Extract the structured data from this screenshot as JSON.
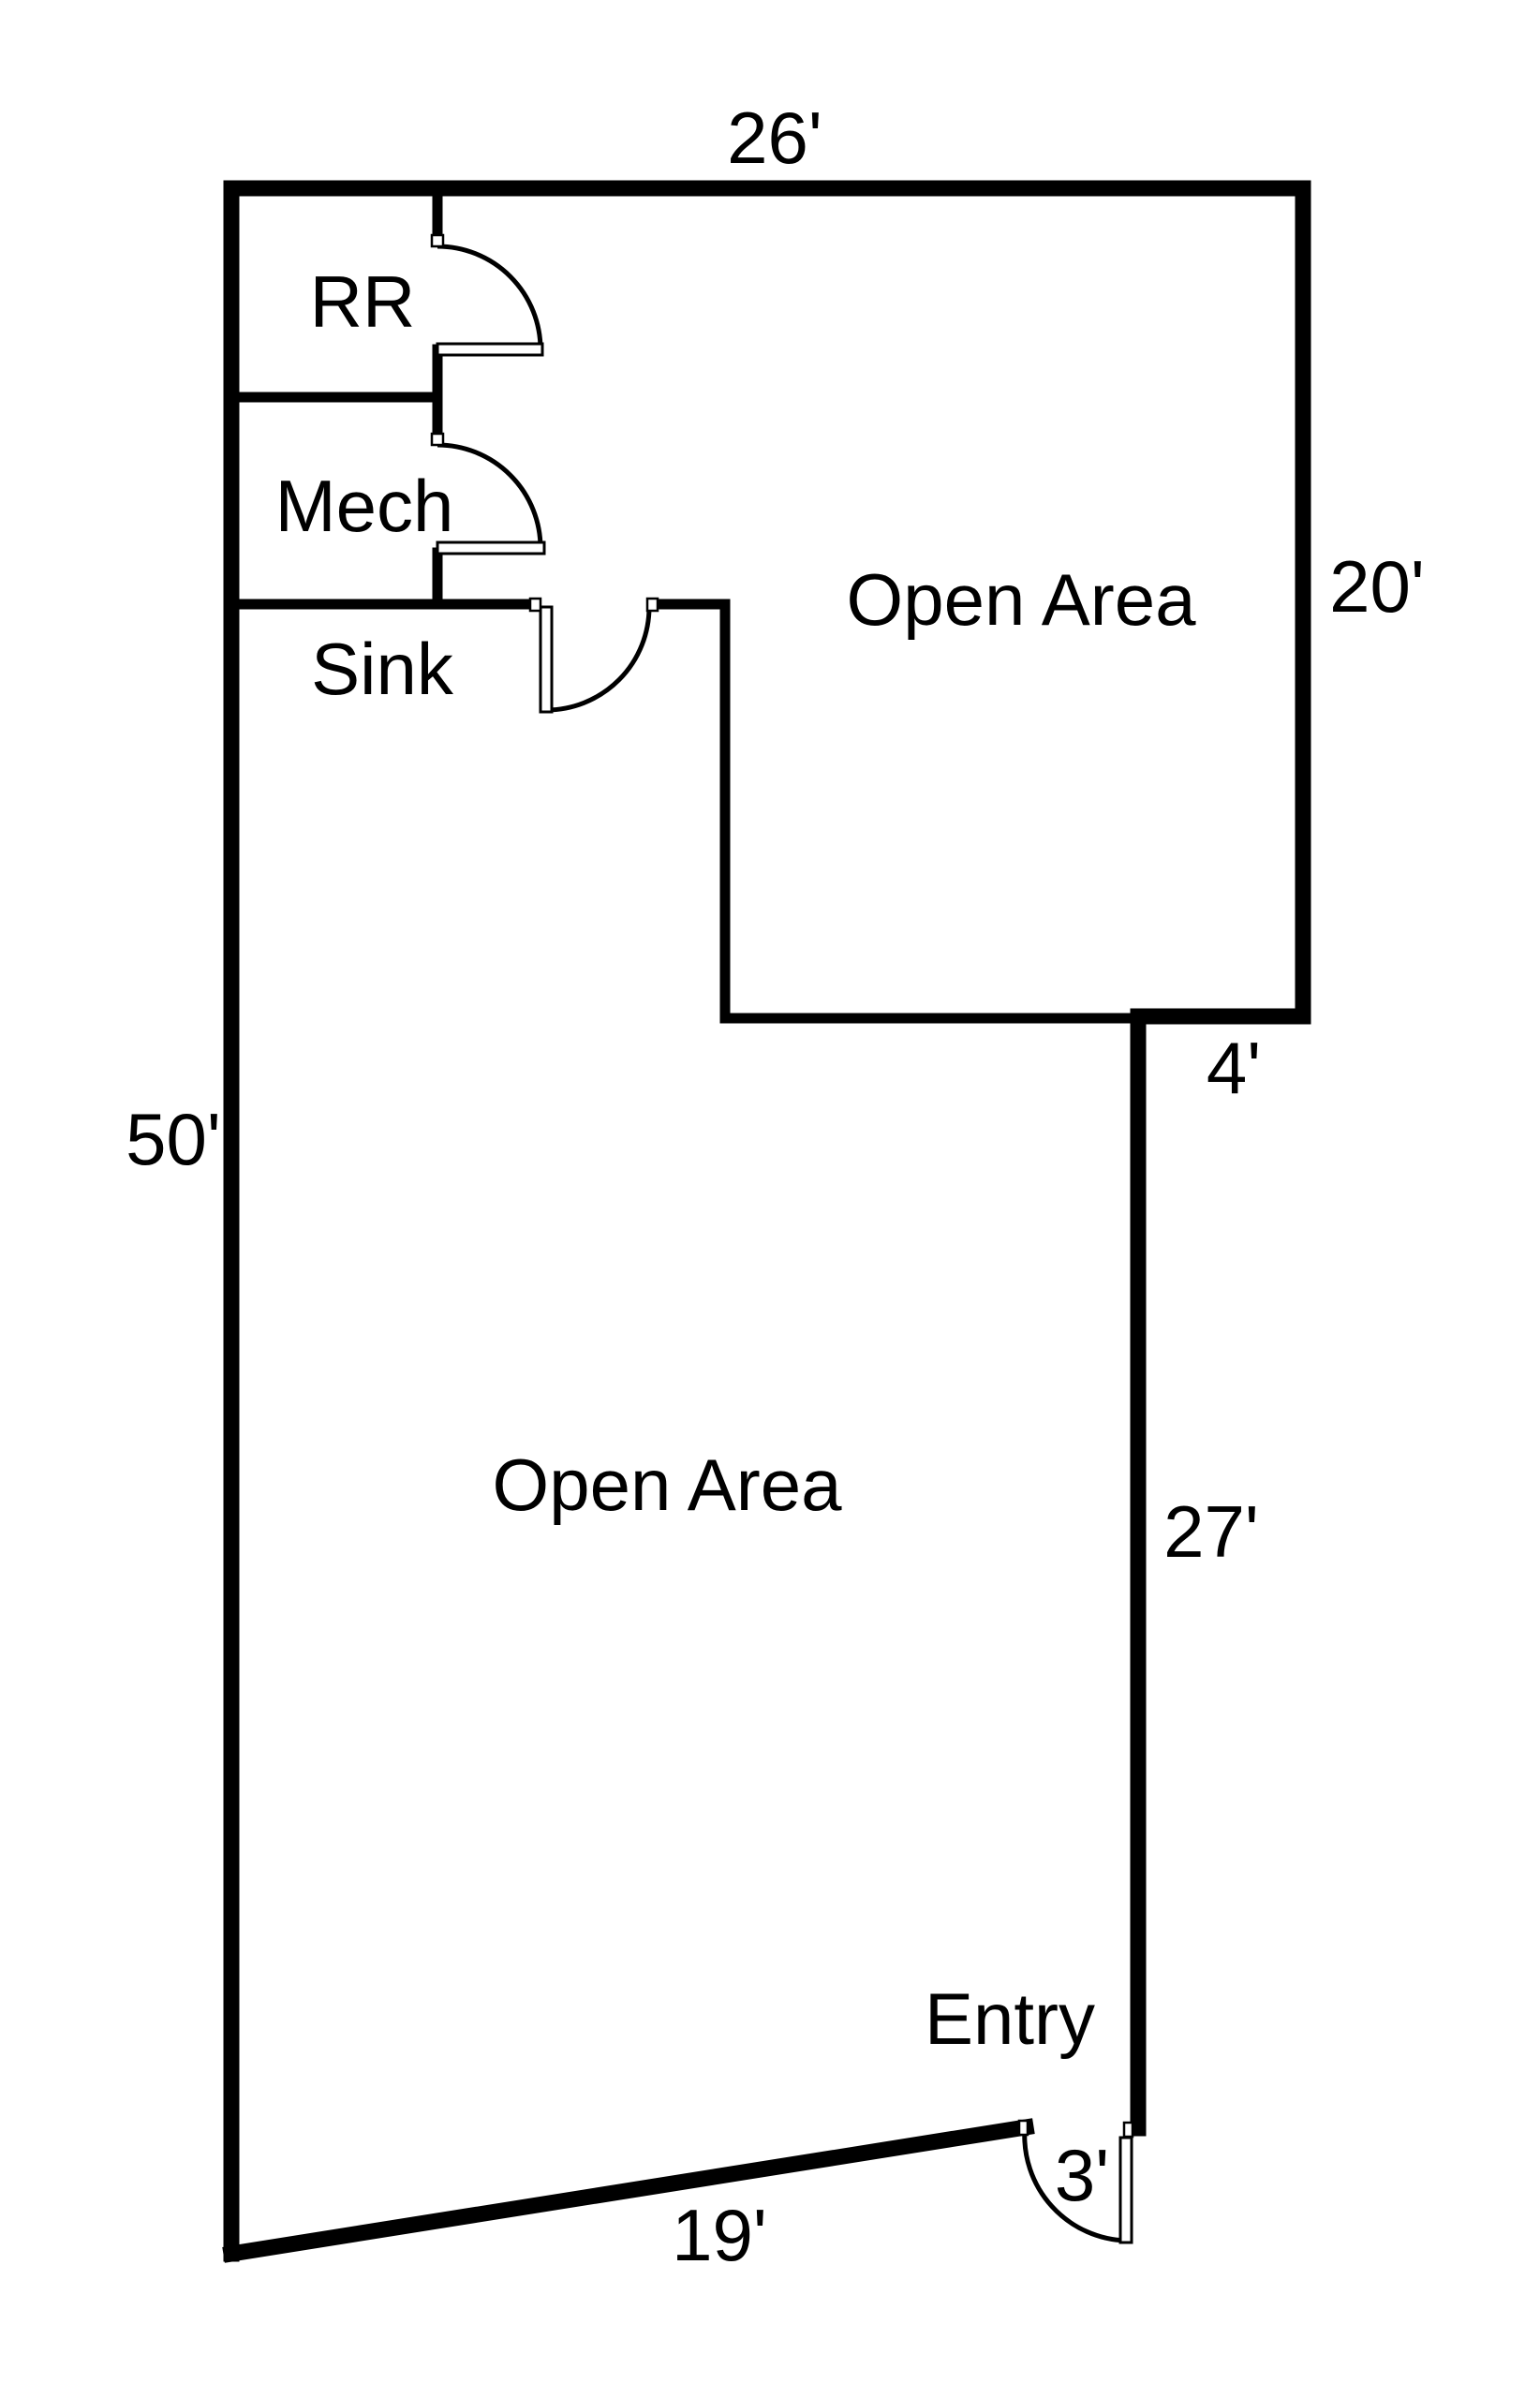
{
  "floor_plan": {
    "background_color": "#ffffff",
    "line_color": "#000000",
    "rooms": {
      "rr": "RR",
      "mech": "Mech",
      "sink": "Sink",
      "open_area_upper": "Open Area",
      "open_area_lower": "Open Area",
      "entry": "Entry"
    },
    "dimensions": {
      "top_wall": "26'",
      "upper_right_wall": "20'",
      "step_wall": "4'",
      "lower_right_wall": "27'",
      "left_wall": "50'",
      "bottom_wall": "19'",
      "entry_door": "3'"
    }
  }
}
